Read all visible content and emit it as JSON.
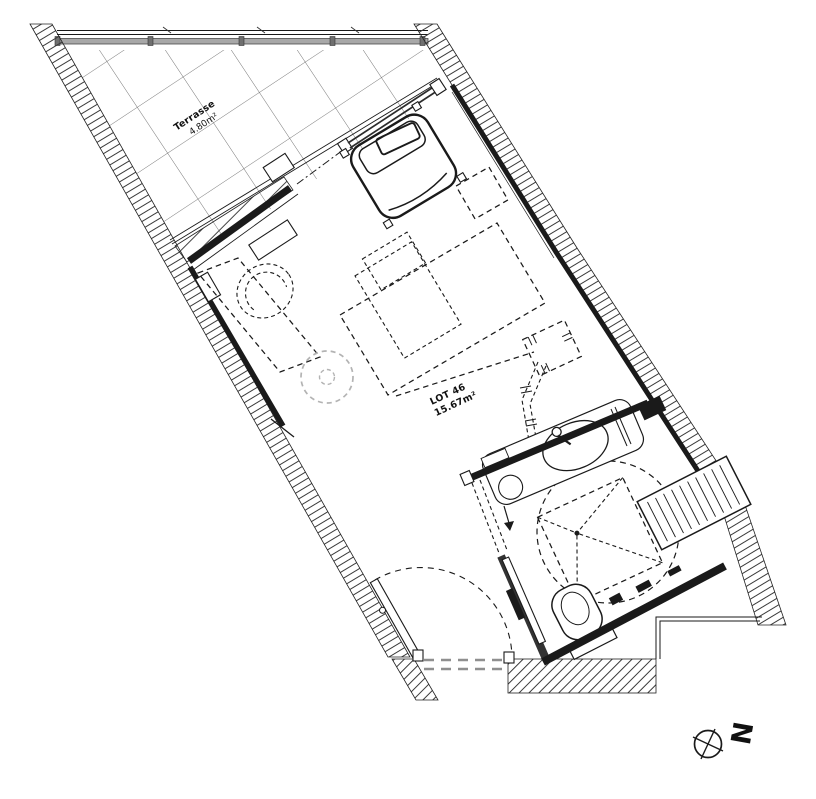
{
  "plan": {
    "terrace": {
      "label": "Terrasse",
      "area": "4.80m²"
    },
    "unit": {
      "label": "LOT 46",
      "area": "15.67m²"
    },
    "north": {
      "label": "N"
    }
  },
  "icons": {
    "north_indicator": "compass-cross-icon"
  },
  "colors": {
    "line": "#1a1a1a",
    "hatch": "#3a3a3a",
    "tile_grid": "#555555",
    "railing_band": "#a8a8a8",
    "muted_gray": "#b3b3b3",
    "threshold_gray": "#8f8f8f",
    "background": "#ffffff"
  }
}
